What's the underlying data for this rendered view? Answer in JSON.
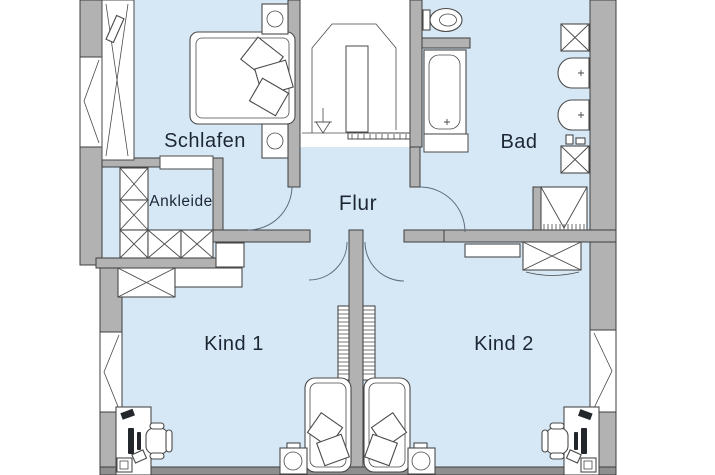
{
  "floorplan": {
    "rooms": {
      "schlafen": {
        "label": "Schlafen"
      },
      "ankleide": {
        "label": "Ankleide"
      },
      "flur": {
        "label": "Flur"
      },
      "bad": {
        "label": "Bad"
      },
      "kind1": {
        "label": "Kind 1"
      },
      "kind2": {
        "label": "Kind 2"
      }
    },
    "colors": {
      "background": "#ffffff",
      "room_fill": "#d6e8f6",
      "wall_fill": "#b2b2b2",
      "wall_outline": "#3d3d3d",
      "cut_strip": "#8f8f8f",
      "furniture_line": "#4a4a4a",
      "label_text": "#1d2733"
    },
    "fixtures": [
      "double-bed",
      "nightstand",
      "wardrobe-cabinet",
      "dresser",
      "staircase",
      "wc-toilet",
      "bathtub",
      "shower",
      "washbasin",
      "bathroom-cabinet",
      "desk",
      "desk-chair",
      "wall-shelf",
      "single-bed",
      "window",
      "door-swing"
    ]
  }
}
